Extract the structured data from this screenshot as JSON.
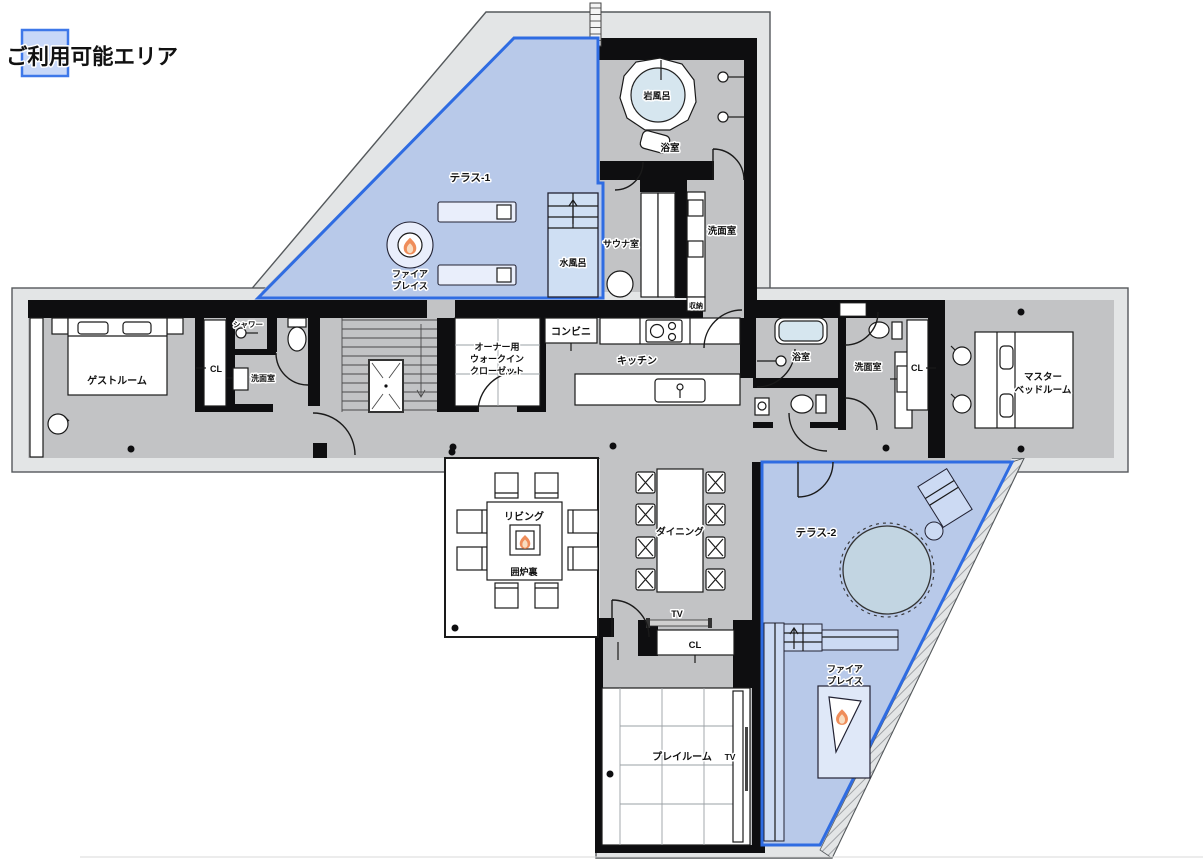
{
  "legend": {
    "label": "ご利用可能エリア"
  },
  "labels": {
    "terrace1": "テラス-1",
    "fireplace1_l1": "ファイア",
    "fireplace1_l2": "プレイス",
    "rock_bath": "岩風呂",
    "bath_top": "浴室",
    "sauna": "サウナ室",
    "cold_bath": "水風呂",
    "washroom_top": "洗面室",
    "storage": "収納",
    "conbini": "コンビニ",
    "kitchen": "キッチン",
    "guest": "ゲストルーム",
    "cl_left": "CL",
    "shower": "シャワー",
    "washroom_left": "洗面室",
    "wic_l1": "オーナー用",
    "wic_l2": "ウォークイン",
    "wic_l3": "クローゼット",
    "bath_right": "浴室",
    "washroom_right": "洗面室",
    "cl_right": "CL",
    "master_l1": "マスター",
    "master_l2": "ベッドルーム",
    "living": "リビング",
    "irori": "囲炉裏",
    "dining": "ダイニング",
    "terrace2": "テラス-2",
    "tv_top": "TV",
    "cl_bottom": "CL",
    "playroom": "プレイルーム",
    "tv_play": "TV",
    "fireplace2_l1": "ファイア",
    "fireplace2_l2": "プレイス"
  },
  "colors": {
    "outer_band": "#e3e5e6",
    "outline": "#55595c",
    "floor": "#c2c3c5",
    "wall": "#0e0e10",
    "room": "#ffffff",
    "terrace_fill": "#b8c9e9",
    "terrace_stroke": "#2f6ce2",
    "legend_fill": "#c8d8f8",
    "legend_stroke": "#3e78e9",
    "water": "#d6e6ef",
    "deck": "#ccdaf3",
    "furn": "#e9eefb",
    "tree": "#c2d5e2",
    "flame1": "#ef8d5a",
    "flame2": "#f8dcc0",
    "text": "#111111"
  }
}
